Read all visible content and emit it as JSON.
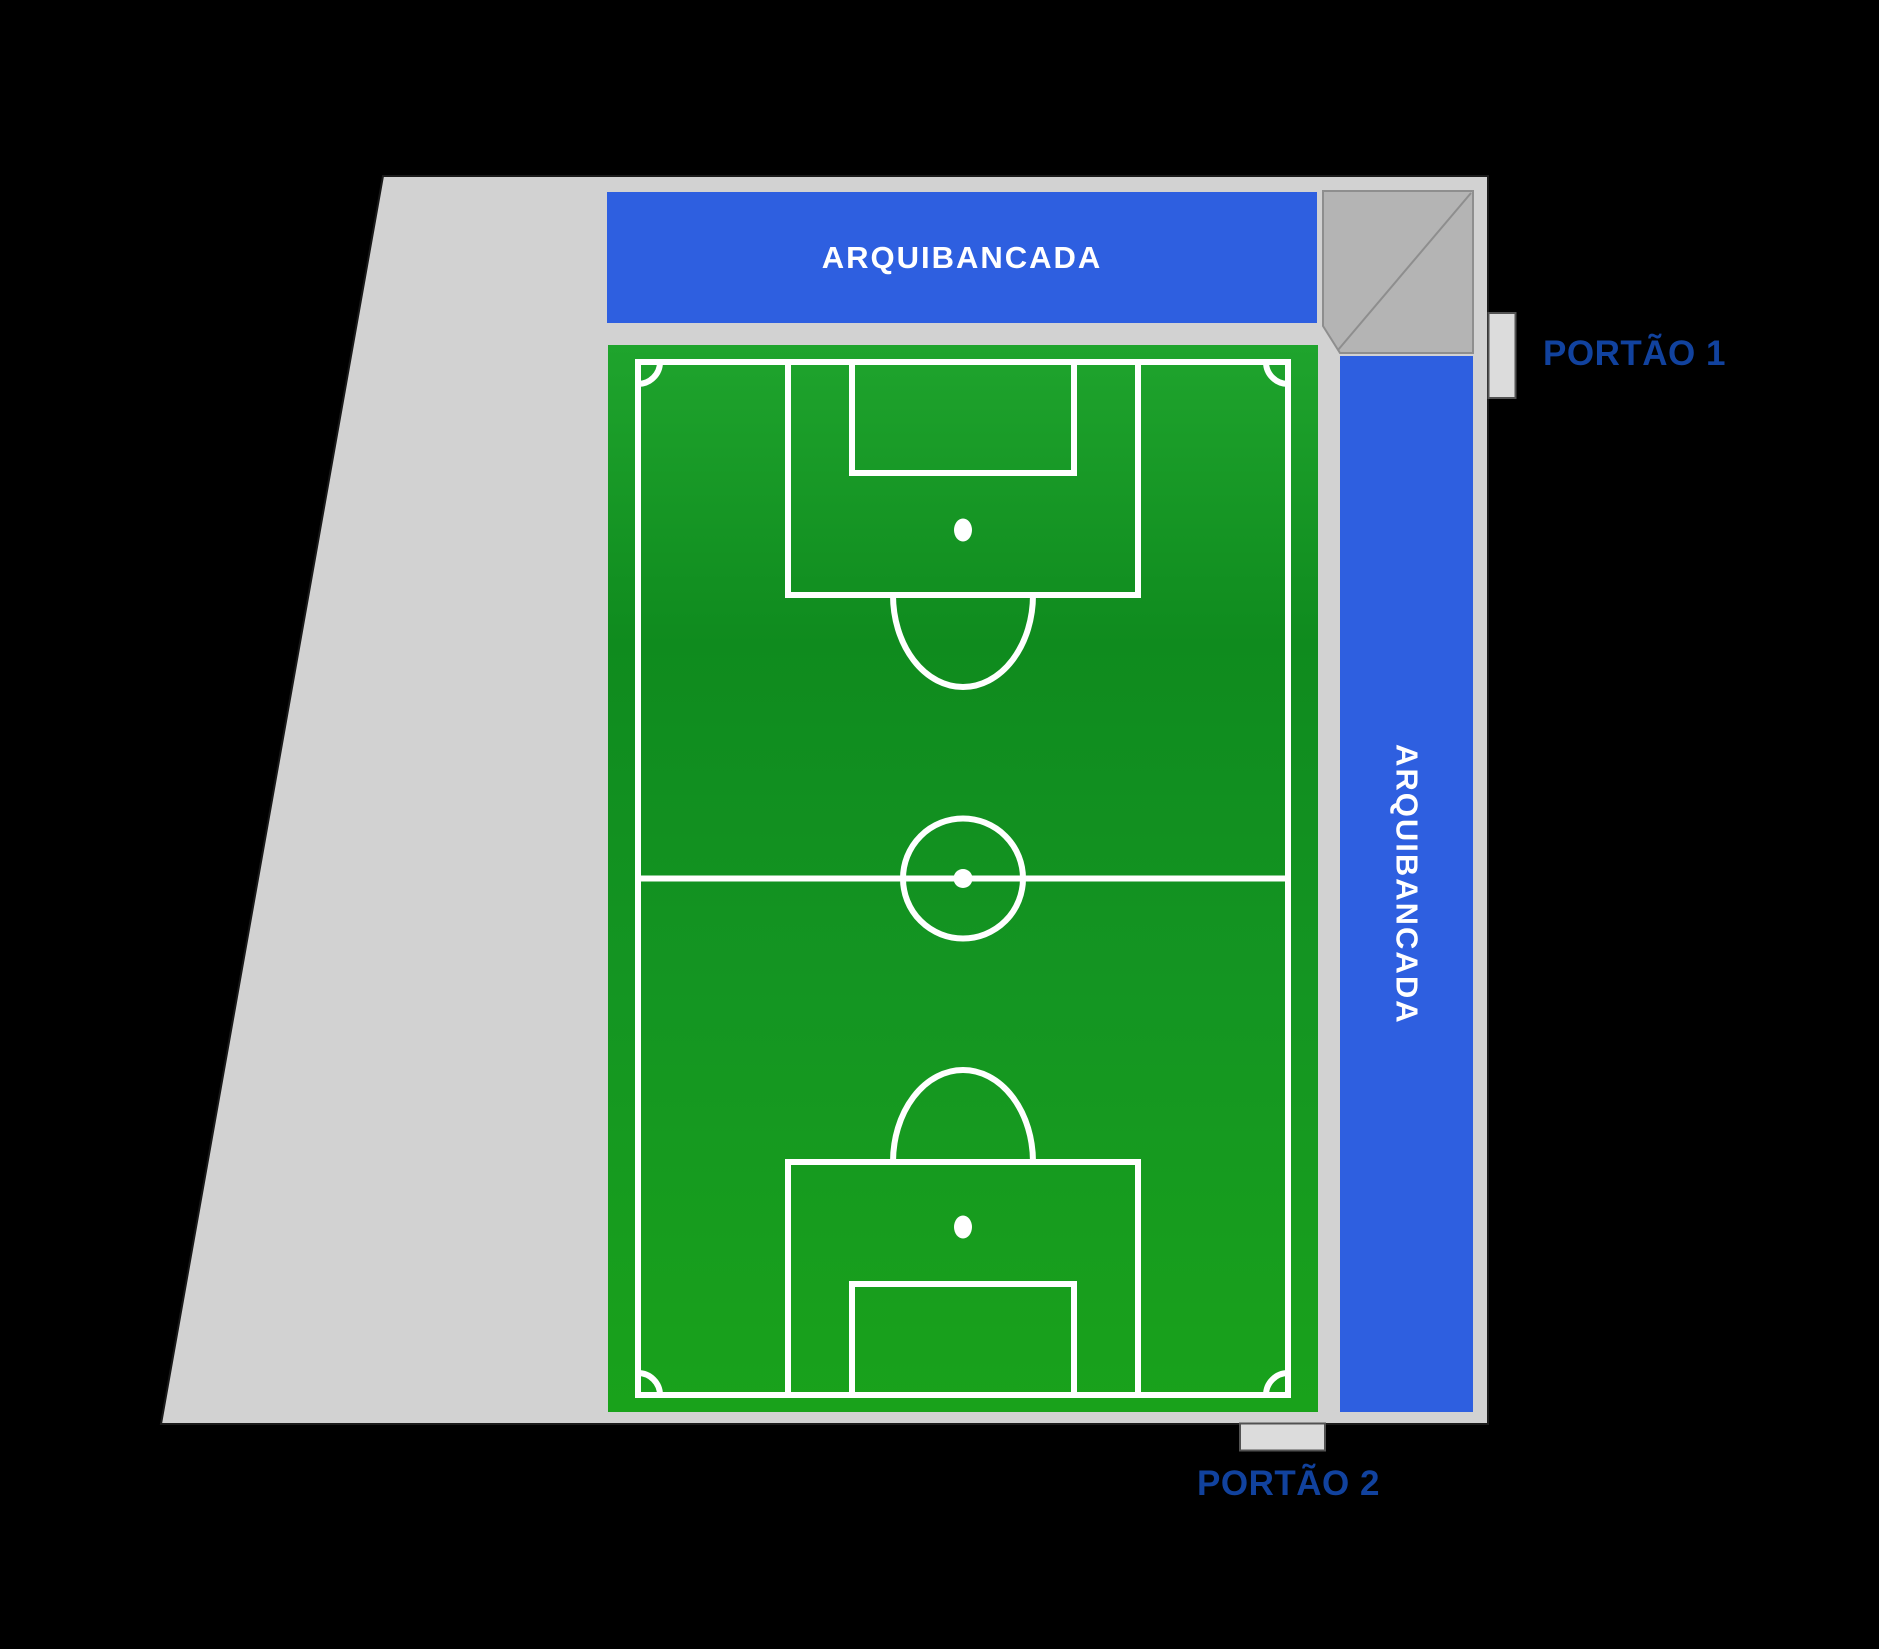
{
  "map": {
    "type": "stadium-access-map",
    "stands": {
      "top": {
        "label": "ARQUIBANCADA"
      },
      "right": {
        "label": "ARQUIBANCADA"
      }
    },
    "gates": {
      "gate1": {
        "label": "PORTÃO 1"
      },
      "gate2": {
        "label": "PORTÃO 2"
      }
    },
    "colors": {
      "background": "#000000",
      "grounds_gray": "#D2D2D2",
      "grounds_outline": "#1A1A1A",
      "corner_stand_gray": "#B4B4B4",
      "corner_stand_outline": "#8E8E8E",
      "gate_gray": "#DCDCDC",
      "gate_outline": "#525252",
      "stand_blue": "#2E5FE0",
      "stand_text": "#FFFFFF",
      "gate_label_blue": "#11429E",
      "field_green_light": "#1FA42D",
      "field_green_dark": "#0F8B1E",
      "field_lines": "#FFFFFF"
    }
  }
}
